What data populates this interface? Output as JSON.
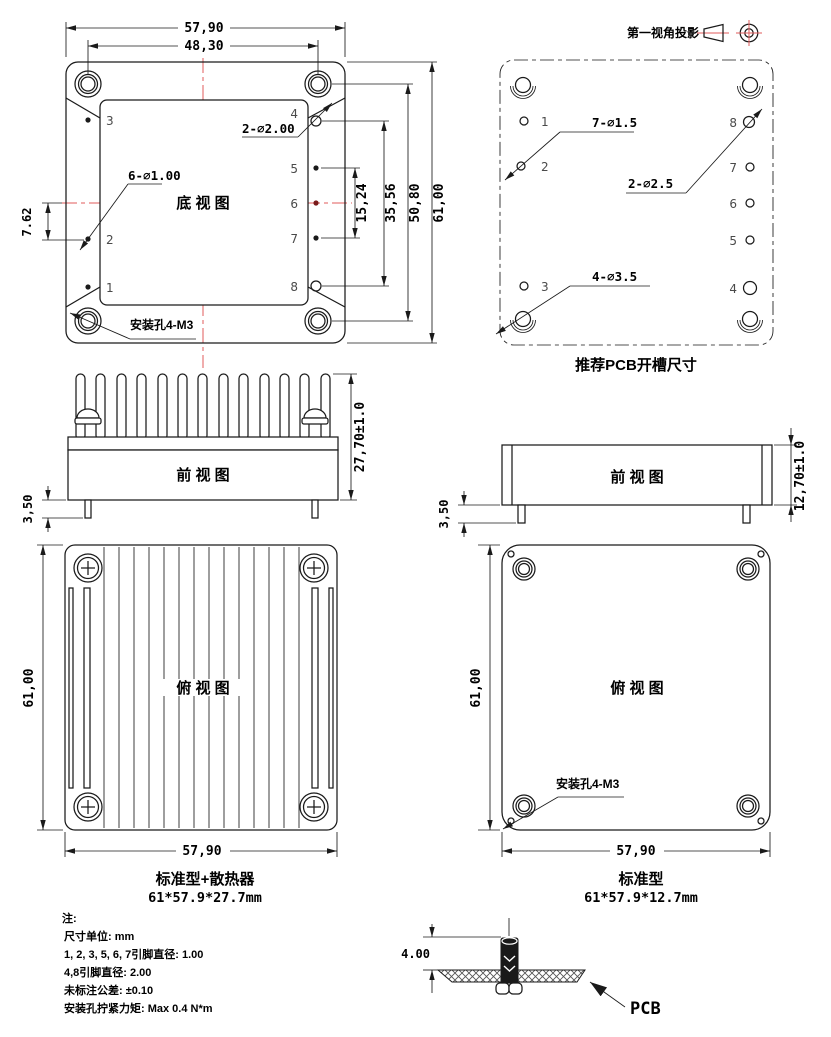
{
  "colors": {
    "line": "#1a1a1a",
    "centerline_red": "#e05b5b",
    "background": "#ffffff",
    "pin_number_gray": "#4a4a4a"
  },
  "projection": {
    "label": "第一视角投影"
  },
  "pin_numbers": [
    "1",
    "2",
    "3",
    "4",
    "5",
    "6",
    "7",
    "8"
  ],
  "bottom_view": {
    "title": "底 视 图",
    "dim_width_outer": "57,90",
    "dim_width_inner": "48,30",
    "dim_pitch": "7.62",
    "dim_pins_span": "15,24",
    "dim_pins_48": "35,56",
    "dim_holes": "50,80",
    "dim_height": "61,00",
    "label_small_pins": "6-∅1.00",
    "label_large_pins": "2-∅2.00",
    "label_mount": "安装孔4-M3"
  },
  "pcb_view": {
    "title": "推荐PCB开槽尺寸",
    "label_small_holes": "7-∅1.5",
    "label_large_holes": "2-∅2.5",
    "label_corner_holes": "4-∅3.5"
  },
  "front_hs": {
    "title": "前 视 图",
    "dim_height": "27,70±1.0",
    "dim_pin": "3,50"
  },
  "front_std": {
    "title": "前 视 图",
    "dim_height": "12,70±1.0",
    "dim_pin": "3,50"
  },
  "top_hs": {
    "title": "俯 视 图",
    "dim_height": "61,00",
    "dim_width": "57,90",
    "caption": "标准型+散热器",
    "size": "61*57.9*27.7mm"
  },
  "top_std": {
    "title": "俯 视 图",
    "dim_height": "61,00",
    "dim_width": "57,90",
    "label_mount": "安装孔4-M3",
    "caption": "标准型",
    "size": "61*57.9*12.7mm"
  },
  "notes": {
    "lines": [
      "注:",
      "尺寸单位: mm",
      "1, 2, 3, 5, 6, 7引脚直径: 1.00",
      "4,8引脚直径: 2.00",
      "未标注公差: ±0.10",
      "安装孔拧紧力矩: Max 0.4 N*m"
    ]
  },
  "pcb_section": {
    "dim": "4.00",
    "label": "PCB"
  }
}
